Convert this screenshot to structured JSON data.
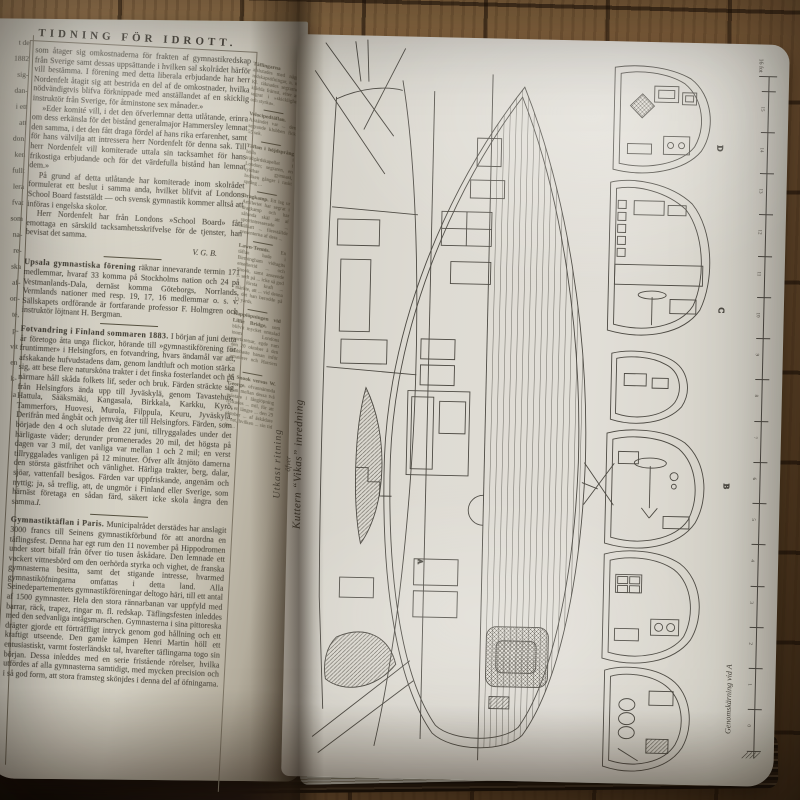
{
  "book": {
    "left_page": {
      "masthead": "TIDNING FÖR IDROTT.",
      "edge_fragments": "t de\n1882\nsig-\ndan-\ni ett\natt\ndon,\nken\nfullt\nlera\nfvat\nsom\nna-\nre-\nska\naf-\non-\nté,\np-\nvit\nen\nk-\nla",
      "column1": {
        "para1": "som åtager sig omkostnaderna för frakten af gymnastikredskap från Sverige samt dessas uppsättande i hvilken sal skolrådet härför vill bestämma. I förening med detta liberala erbjudande har herr Nordenfelt åtagit sig att bestrida en del af de omkostnader, hvilka nödvändigtvis blifva förknippade med anställandet af en skicklig instruktör från Sverige, för åtminstone sex månader.»",
        "para2": "»Eder komité vill, i det den öfverlemnar detta utlåtande, erinra om dess erkänsla för det bistånd generalmajor Hammersley lemnat den samma, i det den fått draga fördel af hans rika erfarenhet, samt för hans välvilja att intressera herr Nordenfelt för denna sak. Till herr Nordenfelt vill komiterade uttala sin tacksamhet för hans frikostiga erbjudande och för det värdefulla bistånd han lemnat dem.»",
        "para3": "På grund af detta utlåtande har komiterade inom skolrådet formulerat ett beslut i samma anda, hvilket blifvit af Londons School Board faststäldt — och svensk gymnastik kommer alltså att införas i engelska skolor.",
        "para4": "Herr Nordenfelt har från Londons »School Board» fått emottaga en särskild tacksamhetsskrifvelse för de tjenster, han bevisat det samma.",
        "signature1": "V. G. B.",
        "lead5": "Upsala gymnastiska förening",
        "para5": " räknar innevarande termin 171 medlemmar, hvaraf 33 komma på Stockholms nation och 24 på Vestmanlands-Dala, dernäst komma Göteborgs, Norrlands, Vermlands nationer med resp. 19, 17, 16 medlemmar o. s. v. Sällskapets ordförande är fortfarande professor F. Holmgren och instruktör löjtnant H. Bergman.",
        "lead6": "Fotvandring i Finland sommaren 1883.",
        "para6": " I början af juni detta år företogo åtta unga flickor, hörande till »gymnastikförening för fruntimmer» i Helsingfors, en fotvandring, hvars ändamål var att, afskakande hufvudstadens dam, genom landtluft och motion stärka sig, att bese flere natursköna trakter i det finska fosterlandet och på närmare håll skåda folkets lif, seder och bruk. Färden sträckte sig från Helsingfors ända upp till Jyväskylä, genom Tavastehus, Hattula, Sääksmäki, Kangasala, Birkkala, Karkku, Kyrö, Tammerfors, Huovesi, Murola, Filppula, Keuru, Jyväskylä. Derifrån med ångbåt och jernväg åter till Helsingfors. Färden, som började den 4 och slutade den 22 juni, tillryggalades under det härligaste väder; derunder promenerades 20 mil, det högsta på dagen var 3 mil, det vanliga var mellan 1 och 2 mil; en verst tillryggalades vanligen på 12 minuter. Öfver allt åtnjöto damerna den största gästfrihet och vänlighet. Härliga trakter, berg, dalar, sjöar, vattenfall besågos. Färden var uppfriskande, angenäm och nyttig; ja, så treflig, att, de ungmör i Finland eller Sverige, som härnäst företaga en sådan färd, säkert icke skola ångra den samma.",
        "signature2": "I.",
        "lead7": "Gymnastiktäflan i Paris.",
        "para7": " Municipalrådet derstädes har anslagit 3000 francs till Seinens gymnastikförbund för att anordna en täflingsfest. Denna har egt rum den 11 november på Hippodromen under stort bifall från öfver tio tusen åskådare. Den lemnade ett vackert vittnesbörd om den oerhörda styrka och vighet, de franska gymnasterna besitta, samt det stigande intresse, hvarmed gymnastiköfningarna omfattas i detta land. Alla Seinedepartementets gymnastikföreningar deltogo häri, till ett antal af 1500 gymnaster. Hela den stora rännarbanan var uppfyld med barrar, räck, trapez, ringar m. fl. redskap. Täflingsfesten inleddes med den sedvanliga intågsmarschen. Gymnasterna i sina pittoreska drägter gjorde ett förträffligt intryck genom god hållning och ett kraftigt utseende. Den gamle kämpen Henri Martin höll ett entusiastiskt, varmt fosterländskt tal, hvarefter täflingarna togo sin början. Dessa inleddes med en serie fristående rörelser, hvilka utfördes af alla gymnasterna samtidigt, med mycken precision och i så god form, att stora framsteg skönjdes i denna del af öfningarna."
      },
      "column2": {
        "items": [
          {
            "head": "Täflingarna",
            "text": " afslutades med några redskapsöfningar, n. m. Kl. räknades segrarne, klädda främst, efter att segrat i »skicklighet och styrka»."
          },
          {
            "head": "Velocipedtäflan.",
            "text": " Afståndet var ... den segrande klubben fick 55 sek."
          },
          {
            "head": "Täflan i höjdsprång",
            "text": " hölls i trädgårdskapellet i London; segraren, en ryktbar gymnast, hvilken gånger i raskt språng ..."
          },
          {
            "head": "Dragkamp.",
            "text": " Ett lag ur Artilleriet har segrat i dragkamp och har sålunda skäl att af sportintresserade ... stålsatt ... föreställde presenterna af dess ..."
          },
          {
            "head": "Lawn-Tennis.",
            "text": " En täflan hade i Birmingham vidtagits emellertid ... och Snook, samt anseende ... sedt på ... icke så god ... första kraft ... märkte, att ... vid denna ... det han berodde på 12 yards."
          },
          {
            "head": "Kapplöpningen vid Lillie Bridge,",
            "text": " som blifvit mycket omtalad inom Londons sportkretsar, egde rum den 20 oktober å den snabbaste banan inför amatörer och Harriers ..."
          },
          {
            "head": "W. Snook versus W. George.",
            "text": " ofvannämnda täflan mellan dessa två mästare i långlöpning lyckades ... mil, för att ... i en längre ... den 29 oktober ... af åskådare ... vet, hvilken ... sin tid för ..."
          }
        ]
      }
    },
    "right_page": {
      "caption_line1": "Utkast ritning",
      "caption_line2": "öfver",
      "caption_line3": "Kuttern “Vikas” inredning",
      "cross_section_caption": "Genomskärning vid A",
      "scale_label": "16 fot",
      "station_a": "A",
      "letters": {
        "d": "D",
        "c": "C",
        "b": "B"
      },
      "scale_ticks": [
        "0",
        "1",
        "2",
        "3",
        "4",
        "5",
        "6",
        "7",
        "8",
        "9",
        "10",
        "11",
        "12",
        "13",
        "14",
        "15",
        "16"
      ]
    }
  }
}
